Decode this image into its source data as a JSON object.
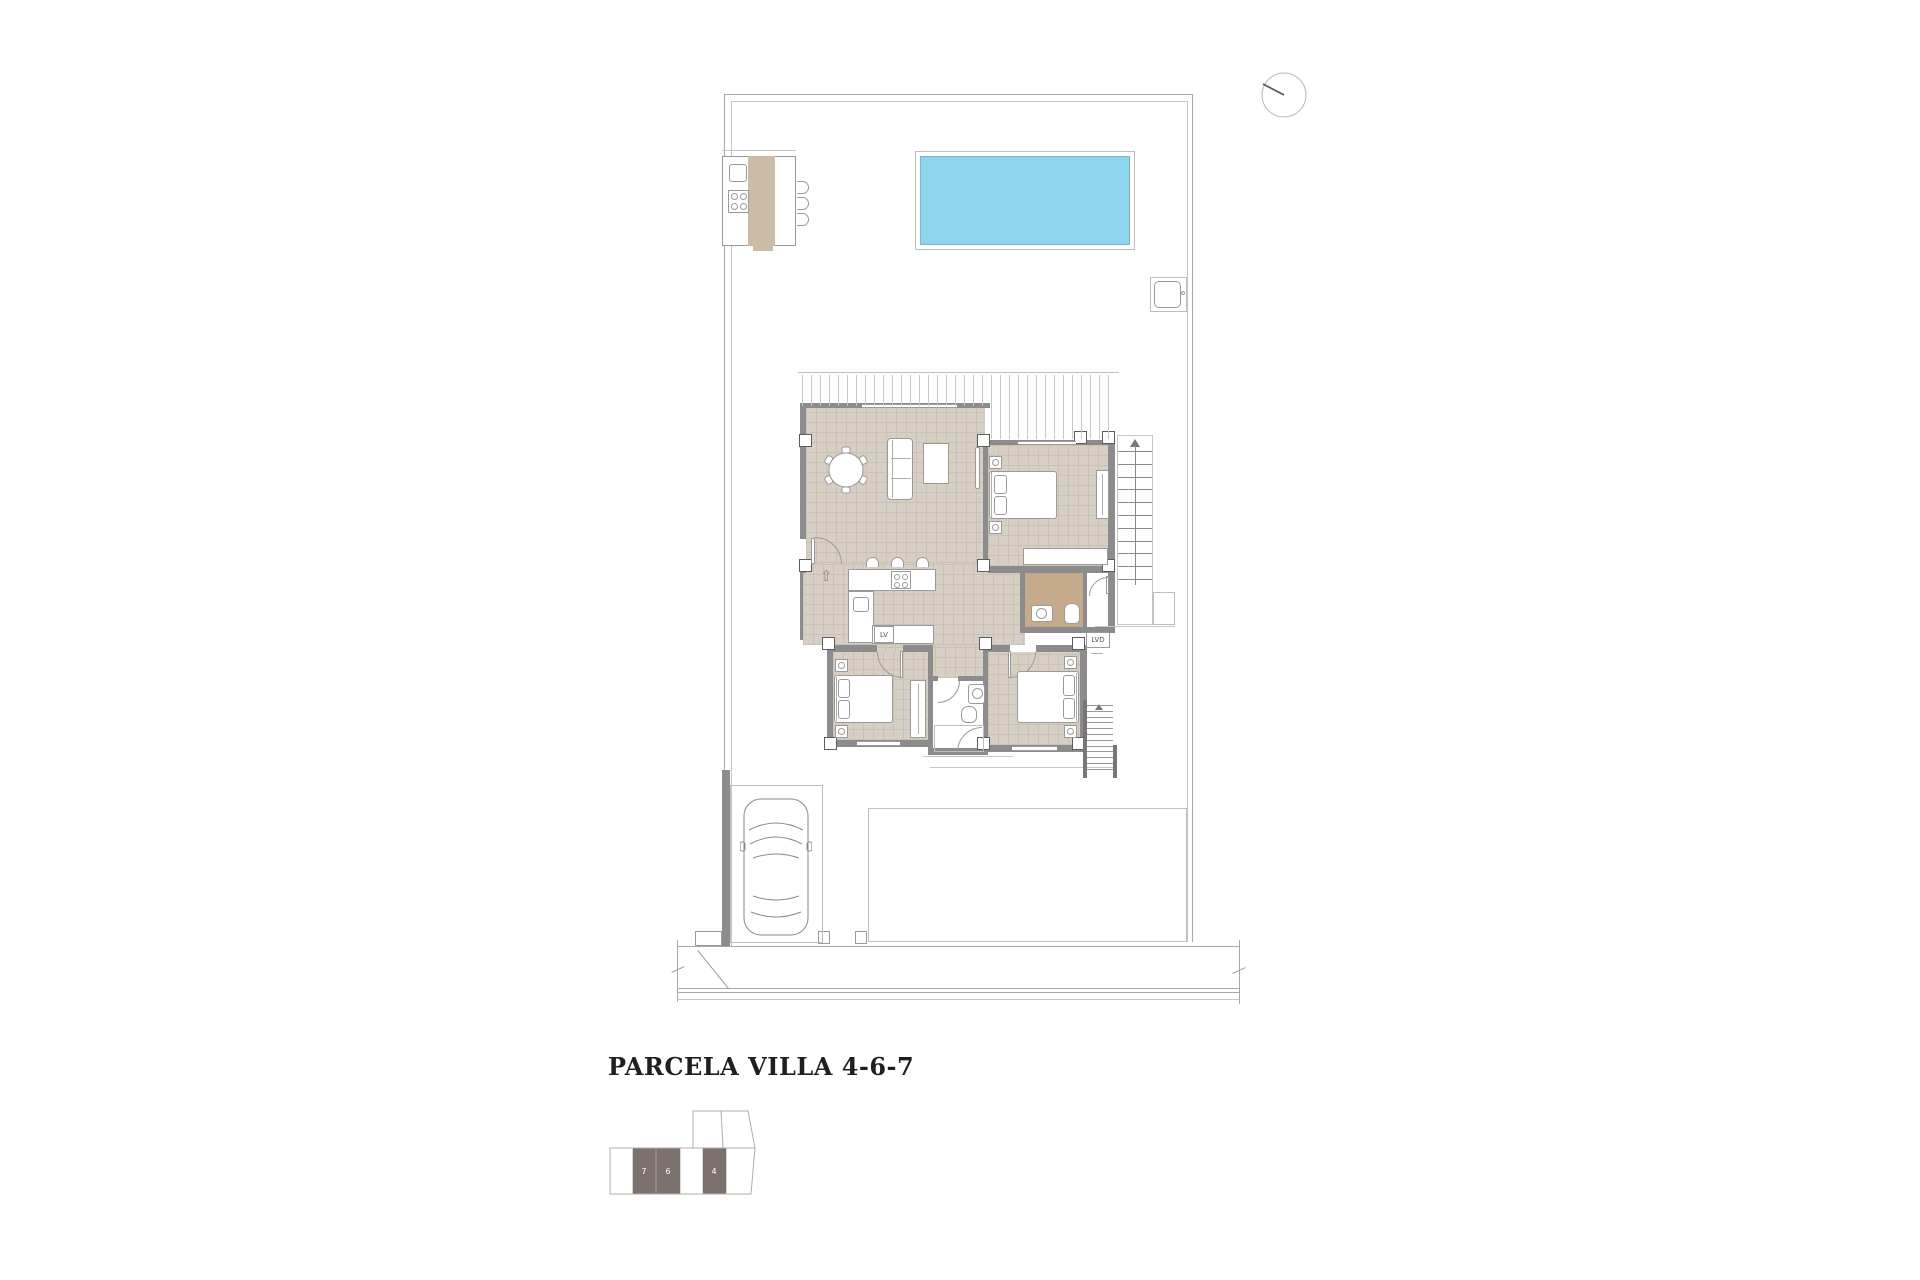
{
  "title": "PARCELA VILLA 4-6-7",
  "plan_labels": {
    "dishwasher": "LV",
    "laundry": "LVD"
  },
  "keyplan": {
    "units": [
      "7",
      "6",
      "4"
    ]
  },
  "icons": {
    "entry_arrow": "⇧"
  },
  "colors": {
    "pool": "#8dd5ef",
    "pool-border": "#7fb2c4",
    "floor": "#d7cec4",
    "floor-line": "#cbc2b6",
    "bath": "#c5aa8c",
    "bbq": "#cbbca8",
    "wall": "#8c8c8c",
    "line": "#a8a8a8",
    "line-light": "#c6c6c6",
    "furn": "#9a9a9a",
    "dark-cell": "#7b7270",
    "title-color": "#1f1f1f",
    "stair": "#8a8a8a"
  }
}
